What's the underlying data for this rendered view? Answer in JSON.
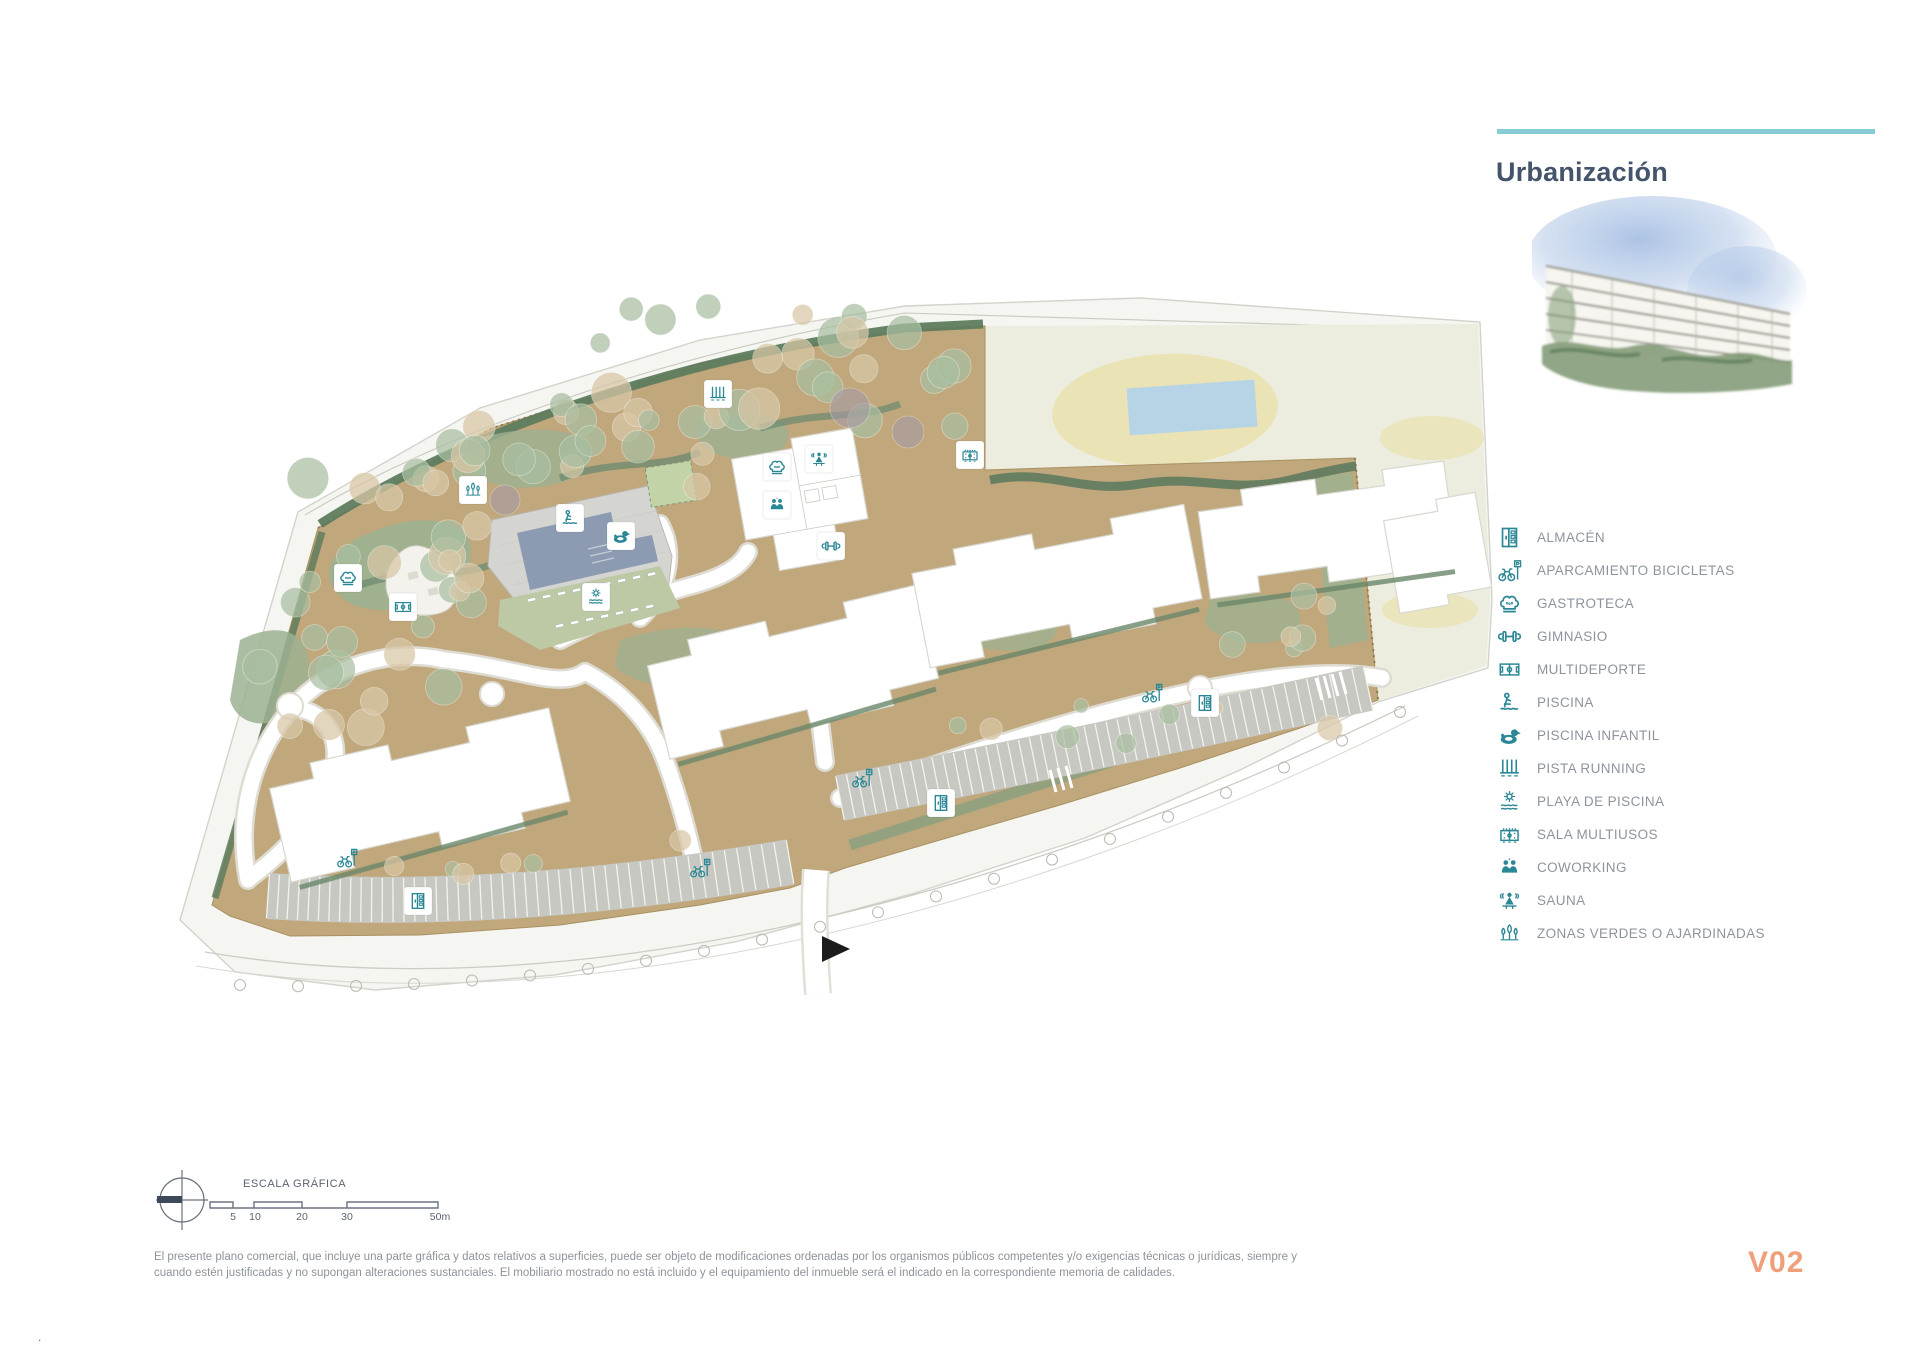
{
  "page": {
    "title": "Urbanización",
    "version": "V02"
  },
  "colors": {
    "accent_teal": "#86ccd5",
    "icon_teal": "#2a8795",
    "title_slate": "#44546a",
    "label_gray": "#8e949e",
    "version_orange": "#efa07b",
    "terrain_tan": "#c0a77c",
    "green_sage": "#9cb292",
    "green_dark": "#5e7c5e",
    "pool_slate": "#8d9bb2",
    "cream_area": "#ecedde",
    "oval_yellow": "#eae3b6",
    "field_blue": "#b7d4e7",
    "parking_gray": "#c8c8c3"
  },
  "legend": {
    "items": [
      {
        "icon": "almacen-icon",
        "label": "ALMACÉN"
      },
      {
        "icon": "bike-parking-icon",
        "label": "APARCAMIENTO BICICLETAS"
      },
      {
        "icon": "gastroteca-icon",
        "label": "GASTROTECA"
      },
      {
        "icon": "gimnasio-icon",
        "label": "GIMNASIO"
      },
      {
        "icon": "multideporte-icon",
        "label": "MULTIDEPORTE"
      },
      {
        "icon": "piscina-icon",
        "label": "PISCINA"
      },
      {
        "icon": "piscina-infantil-icon",
        "label": "PISCINA INFANTIL"
      },
      {
        "icon": "pista-running-icon",
        "label": "PISTA RUNNING"
      },
      {
        "icon": "playa-piscina-icon",
        "label": "PLAYA DE PISCINA"
      },
      {
        "icon": "sala-multiusos-icon",
        "label": "SALA MULTIUSOS"
      },
      {
        "icon": "coworking-icon",
        "label": "COWORKING"
      },
      {
        "icon": "sauna-icon",
        "label": "SAUNA"
      },
      {
        "icon": "zonas-verdes-icon",
        "label": "ZONAS VERDES O AJARDINADAS"
      }
    ]
  },
  "scale_bar": {
    "title": "ESCALA GRÁFICA",
    "labels": [
      "5",
      "10",
      "20",
      "30",
      "50m"
    ]
  },
  "disclaimer": {
    "line1": "El presente plano comercial, que incluye una parte gráfica y datos relativos a superficies, puede ser objeto de modificaciones ordenadas por los organismos públicos competentes y/o exigencias técnicas o jurídicas, siempre y",
    "line2": "cuando estén justificadas y no supongan alteraciones sustanciales. El mobiliario mostrado no está incluido y el equipamiento del inmueble será el indicado en la correspondiente memoria de calidades."
  }
}
